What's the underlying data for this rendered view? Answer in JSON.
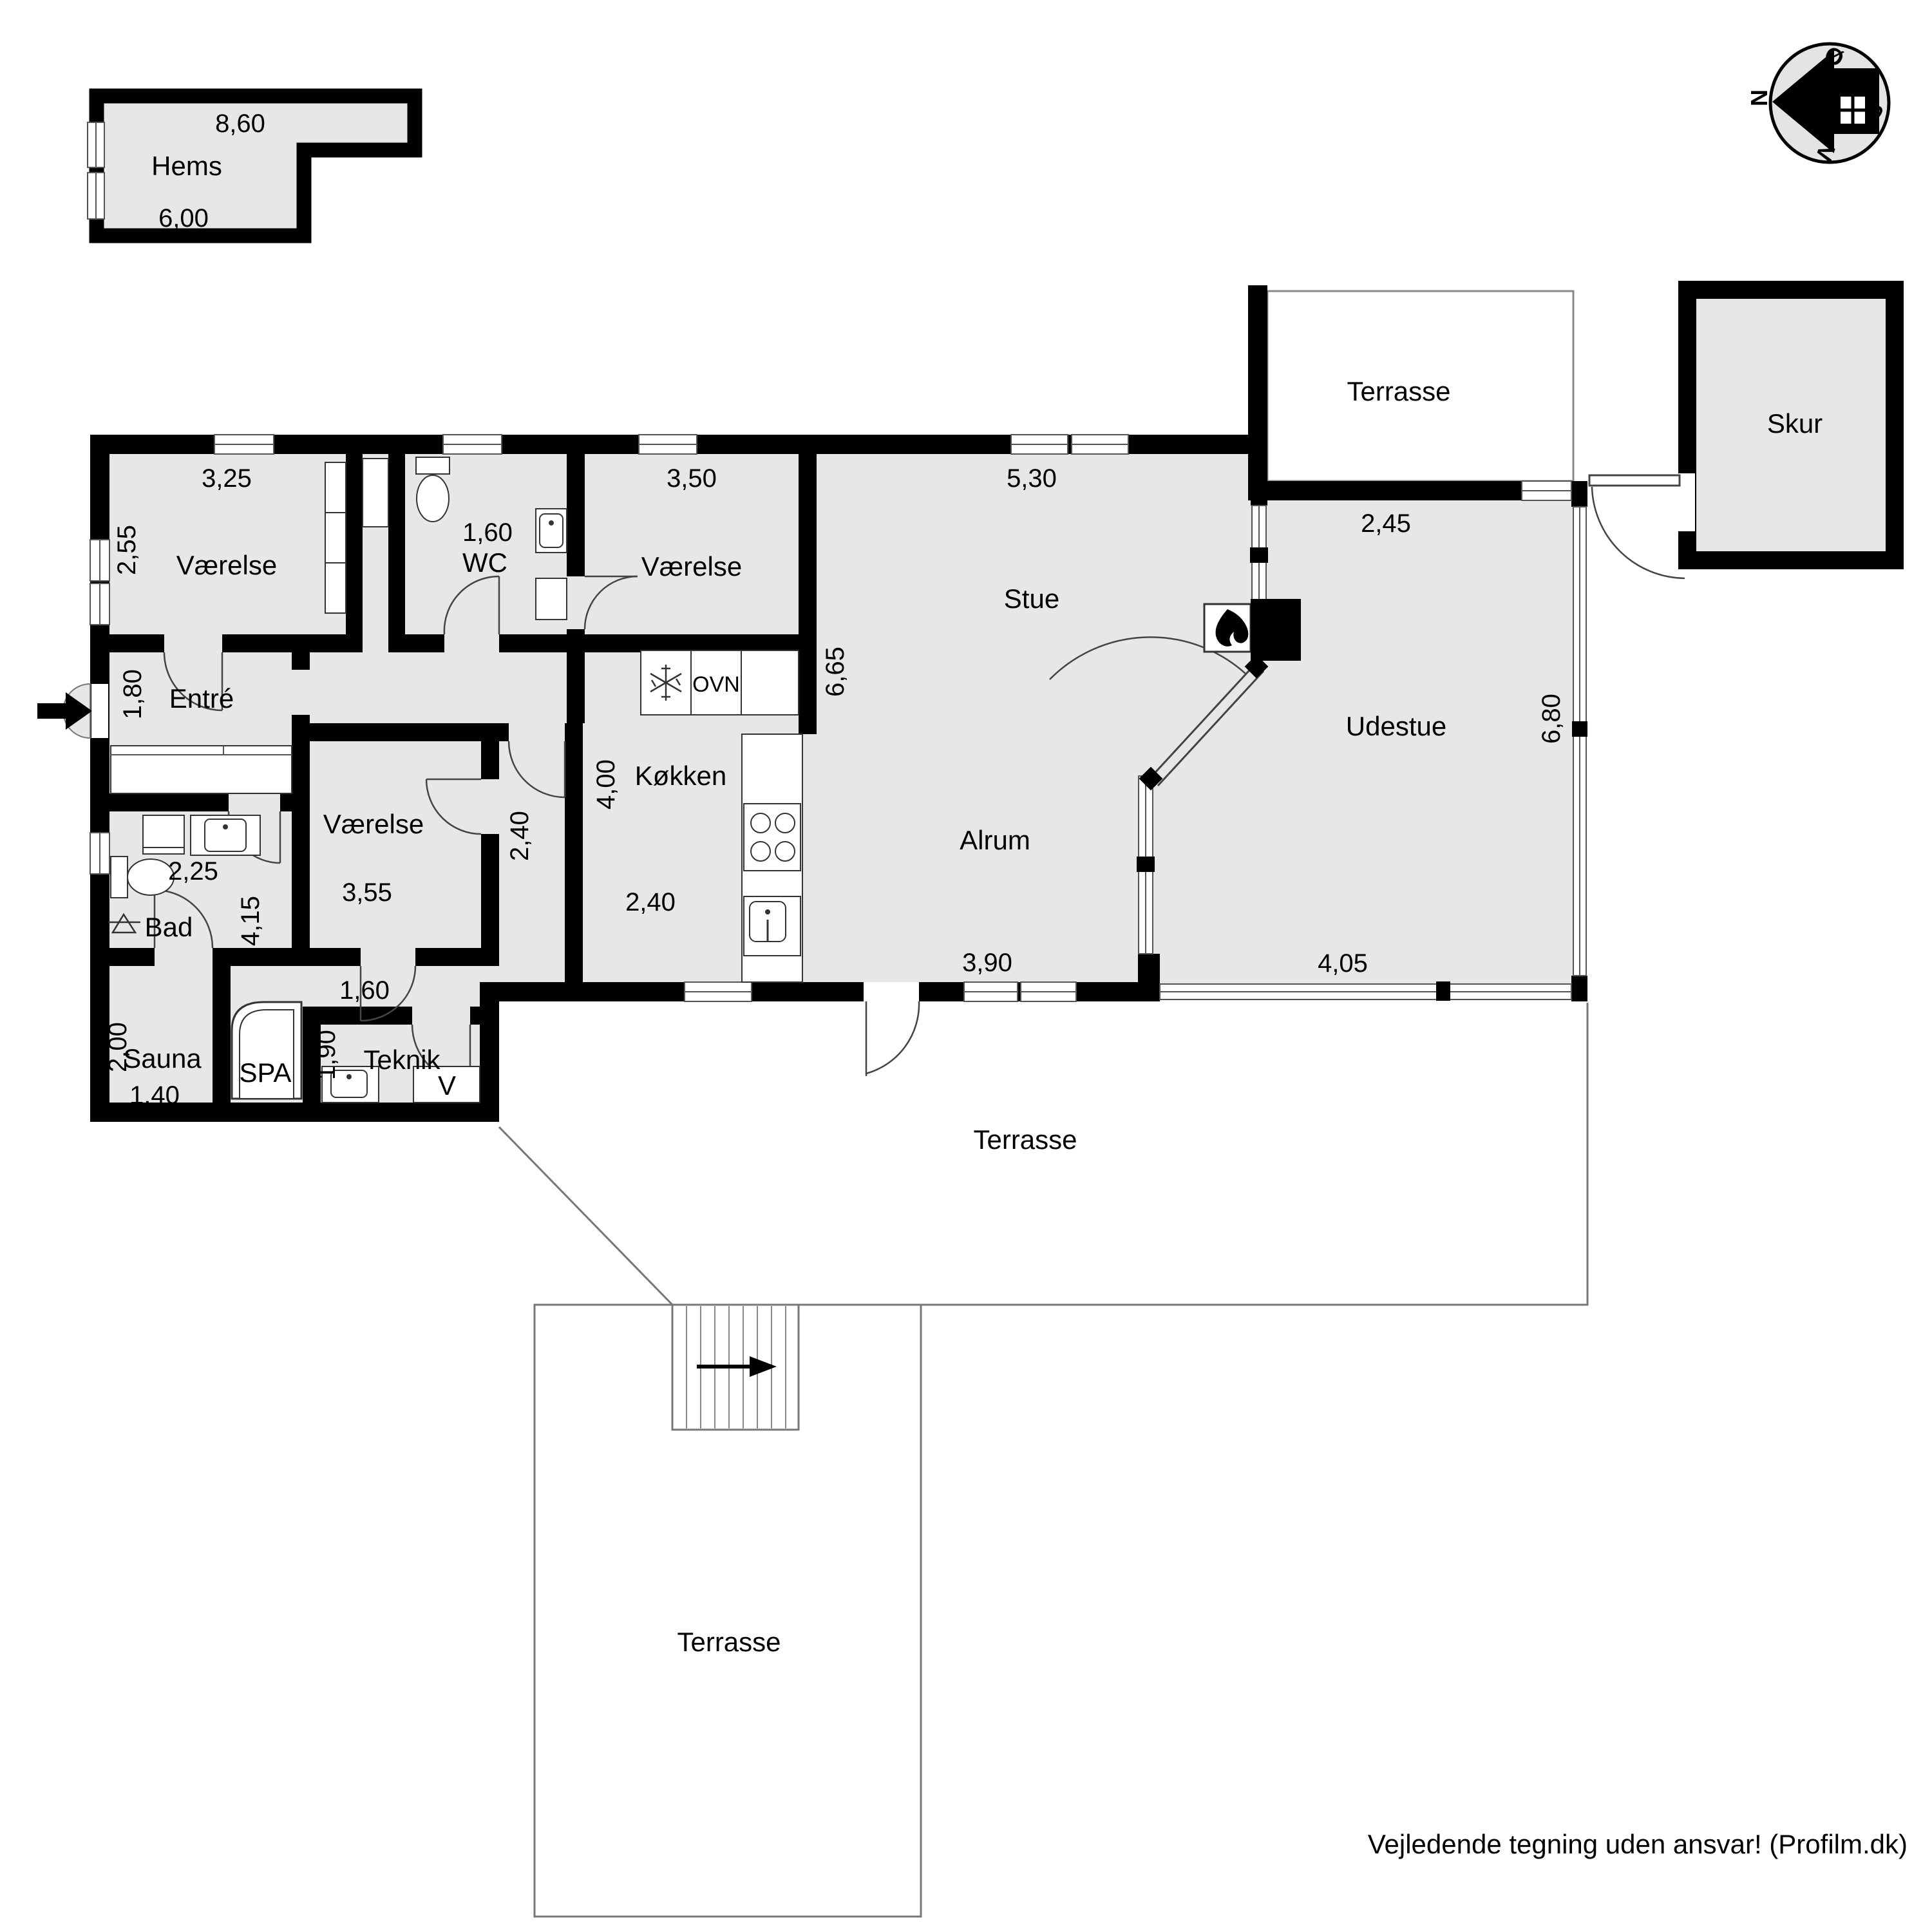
{
  "plan": {
    "disclaimer": "Vejledende tegning uden ansvar! (Profilm.dk)",
    "compass": {
      "north": "N",
      "east": "Ø",
      "south": "S",
      "west": "V"
    },
    "hems": {
      "name": "Hems",
      "dim_top": "8,60",
      "dim_bottom": "6,00"
    },
    "skur": {
      "name": "Skur"
    },
    "terrasse_top": {
      "name": "Terrasse"
    },
    "terrasse_mid": {
      "name": "Terrasse"
    },
    "terrasse_bottom": {
      "name": "Terrasse"
    },
    "vaerelse1": {
      "name": "Værelse",
      "dim_w": "3,25",
      "dim_h": "2,55"
    },
    "wc": {
      "name": "WC",
      "dim": "1,60"
    },
    "vaerelse2": {
      "name": "Værelse",
      "dim_w": "3,50"
    },
    "stue": {
      "name": "Stue",
      "dim_w": "5,30",
      "dim_h": "6,65"
    },
    "udestue": {
      "name": "Udestue",
      "dim_top": "2,45",
      "dim_h": "6,80",
      "dim_bottom": "4,05"
    },
    "entre": {
      "name": "Entré",
      "dim": "1,80"
    },
    "vaerelse3": {
      "name": "Værelse",
      "dim_w": "3,55",
      "dim_h": "2,40"
    },
    "koekken": {
      "name": "Køkken",
      "dim_h": "4,00",
      "dim_w": "2,40",
      "oven": "OVN"
    },
    "alrum": {
      "name": "Alrum",
      "dim_w": "3,90"
    },
    "bad": {
      "name": "Bad",
      "dim_w": "2,25",
      "dim_h": "4,15"
    },
    "sauna": {
      "name": "Sauna",
      "dim_h": "2,00",
      "dim_w": "1,40"
    },
    "spa": {
      "name": "SPA"
    },
    "teknik": {
      "name": "Teknik",
      "dim_w": "1,60",
      "dim_h": "1,90",
      "v_label": "V"
    },
    "vestibule": {
      "dim": "1,60"
    }
  },
  "colors": {
    "wall": "#000000",
    "room_fill": "#e7e7e7",
    "outline": "#777777"
  }
}
